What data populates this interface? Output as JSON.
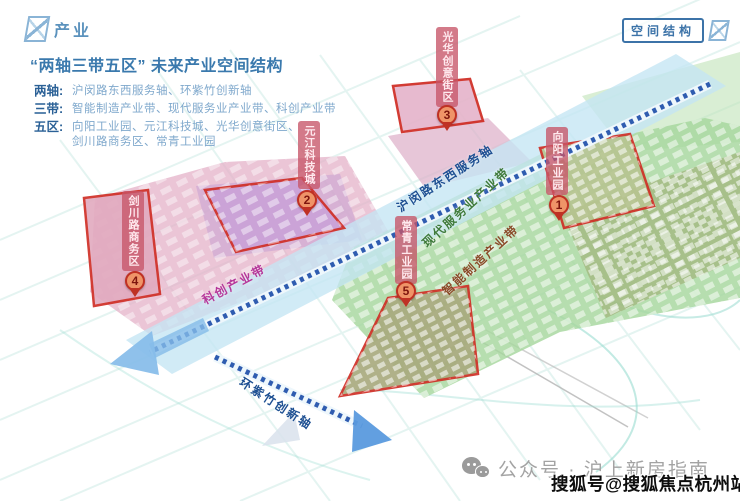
{
  "brand": {
    "logo_text": "产业"
  },
  "header_tag": {
    "label": "空间结构"
  },
  "title": "“两轴三带五区” 未来产业空间结构",
  "legend": {
    "rows": [
      {
        "label": "两轴:",
        "text": "沪闵路东西服务轴、环紫竹创新轴"
      },
      {
        "label": "三带:",
        "text": "智能制造产业带、现代服务业产业带、科创产业带"
      },
      {
        "label": "五区:",
        "text": "向阳工业园、元江科技城、光华创意街区、",
        "text2": "剑川路商务区、常青工业园"
      }
    ]
  },
  "map": {
    "axis_labels": {
      "humin": "沪闵路东西服务轴",
      "ring": "环紫竹创新轴"
    },
    "belt_labels": {
      "modern": "现代服务业产业带",
      "scitech": "科创产业带",
      "intelmfg": "智能制造产业带"
    },
    "zones": [
      {
        "num": "1",
        "name": "向阳工业园"
      },
      {
        "num": "2",
        "name": "元江科技城"
      },
      {
        "num": "3",
        "name": "光华创意街区"
      },
      {
        "num": "4",
        "name": "剑川路商务区"
      },
      {
        "num": "5",
        "name": "常青工业园"
      }
    ]
  },
  "footer": {
    "account_text": "公众号 · 沪上新房指南",
    "watermark": "搜狐号@搜狐焦点杭州站"
  },
  "colors": {
    "title_blue": "#3a79ad",
    "legend_label_blue": "#2a6096",
    "legend_text_blue": "#7fa8cc",
    "corridor_blue": "#c4e6f4",
    "railway_blue": "#2f5cb0",
    "pink_belt": "#e3aec6",
    "purple_zone": "#c9a3d2",
    "green_belt": "#a6d79e",
    "olive_band": "#9aa86b",
    "zone_outline_red": "#cf2b22",
    "callout_bg": "#c65468",
    "axis_label_blue": "#1d4f92",
    "modern_belt_green": "#3e7a3a",
    "scitech_magenta": "#b5379a",
    "intelmfg_brown": "#8a4a28"
  }
}
